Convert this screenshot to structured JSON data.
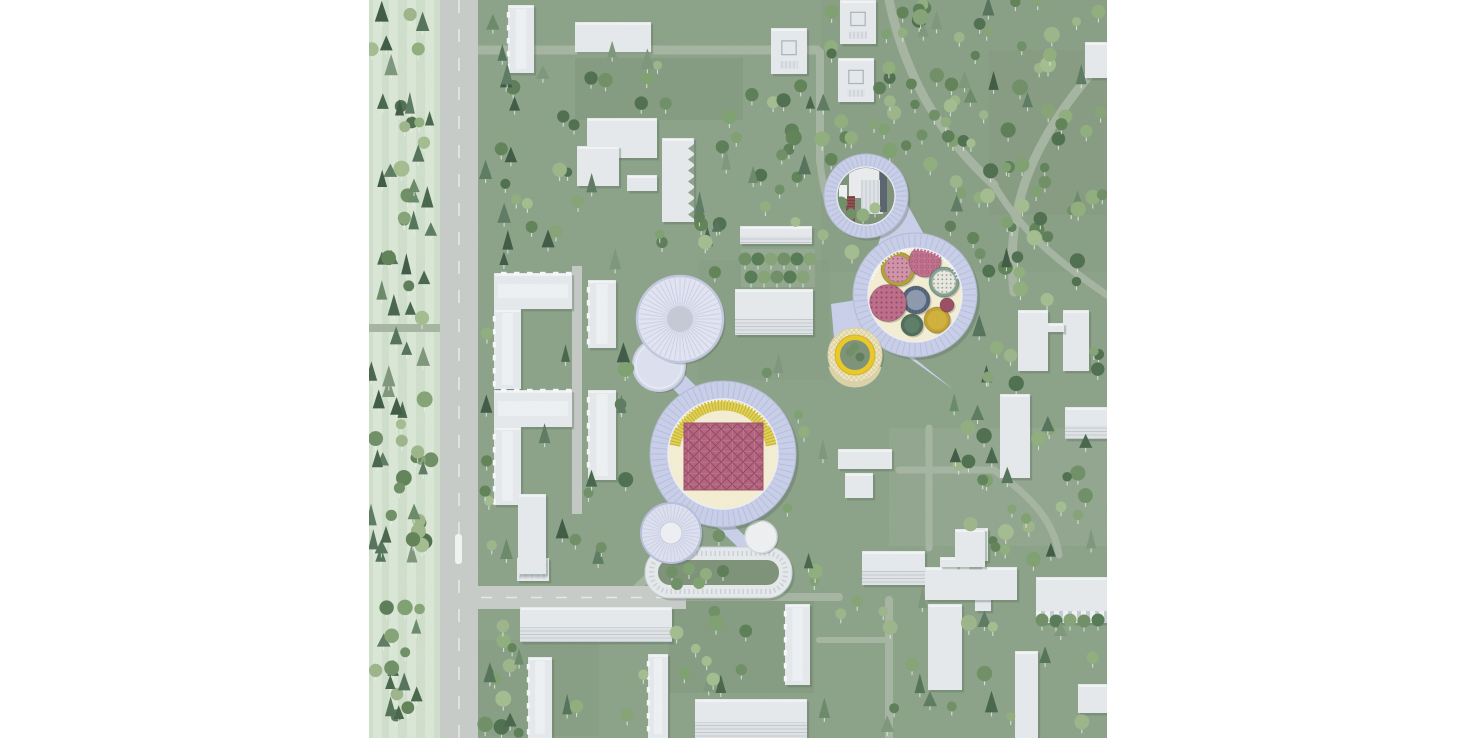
{
  "meta": {
    "title": "Aerial campus site plan illustration",
    "image_width": 1476,
    "image_height": 738,
    "map_left": 369,
    "map_size": 738,
    "visible_text": "none"
  },
  "palette": {
    "bg": "#8ba289",
    "bg_dark": "#7f957a",
    "bg_dark2": "#83987d",
    "bg_light": "#97a893",
    "pale": "#d0dfcc",
    "pale_band": "#dce9d8",
    "road": "#c7cbc8",
    "road_line": "#e8eae7",
    "path": "#a6b4a2",
    "street": "#c3c8c4",
    "bldg": "#e6e9ec",
    "bldg_hi": "#f2f4f6",
    "bldg_stripe": "#c6ccd2",
    "bldg_detail": "#aeb6bd",
    "shadow": "rgba(88,108,92,0.35)",
    "lav": "#c9cfe9",
    "lav_dark": "#b7bedb",
    "lav_light": "#e1e4f2",
    "lav_roof": "#dde1f0",
    "lav_spoke": "#ccd1e6",
    "gray_core": "#c5c9d5",
    "white_core": "#edeff4",
    "cream": "#f4eed3",
    "court_green": "#7d9278",
    "yellow": "#e4d255",
    "yellow_dark": "#c6b63b",
    "yellow_bright": "#eac827",
    "lattice": "#efe7c3",
    "rose": "#b4627d",
    "rose_line": "#8f4760",
    "olive": "#b2a232",
    "pink_top": "#cf93a8",
    "rose_disc": "#c2718c",
    "teal": "#7fa091",
    "blue": "#5a6a83",
    "blue_top": "#8c99ad",
    "rose_dot": "#bd6d88",
    "dkgreen": "#4e6e5a",
    "mustard": "#c3a02c",
    "maroon": "#9a4d64",
    "red_tower": "#7a3a3e",
    "dark_slab": "#59646f",
    "stem": "rgba(236,243,234,0.75)",
    "tree_round": [
      "#6f8f66",
      "#7fa070",
      "#8fae7d",
      "#5d7d58",
      "#a4bd8f",
      "#4f6f4f",
      "#9db58a",
      "#618257",
      "#86a377"
    ],
    "tree_conifer": [
      "#3f5a45",
      "#54735a",
      "#6a8a68",
      "#7e967b",
      "#48664c",
      "#5d7a62"
    ]
  },
  "landmarks": {
    "research_ring": {
      "cx": 546,
      "cy": 295,
      "outer_r": 62,
      "inner_r": 47,
      "cylinders": [
        {
          "name": "olive-drum",
          "cx": 529,
          "cy": 269,
          "r": 17,
          "body": "#b2a232",
          "top": "pink-dots"
        },
        {
          "name": "rose-disc",
          "cx": 556,
          "cy": 261,
          "r": 16,
          "body": "floral-rose"
        },
        {
          "name": "teal-drum",
          "cx": 575,
          "cy": 282,
          "r": 15,
          "body": "#7fa091",
          "top": "cream-dots"
        },
        {
          "name": "blue-drum",
          "cx": 547,
          "cy": 300,
          "r": 14,
          "body": "ribbed-blue",
          "top": "#8c99ad"
        },
        {
          "name": "rose-dotted-disc",
          "cx": 519,
          "cy": 303,
          "r": 18.5,
          "body": "rose-dots"
        },
        {
          "name": "green-drum",
          "cx": 543,
          "cy": 325,
          "r": 11,
          "body": "#4e6e5a"
        },
        {
          "name": "mustard-drum",
          "cx": 568,
          "cy": 320,
          "r": 13,
          "body": "#c3a02c"
        },
        {
          "name": "maroon-disc",
          "cx": 578,
          "cy": 305,
          "r": 7,
          "body": "#9a4d64"
        }
      ]
    },
    "gasholder_ring": {
      "cx": 497,
      "cy": 196,
      "outer_r": 42,
      "inner_r": 29
    },
    "yellow_pavilion": {
      "cx": 486,
      "cy": 355,
      "outer_r": 27,
      "ring_r": 20,
      "inner_r": 15
    },
    "central_ring": {
      "cx": 354,
      "cy": 454,
      "outer_r": 73,
      "inner_r": 55,
      "rose_square": [
        315,
        423,
        79,
        67
      ],
      "seating_arc": [
        190,
        350
      ]
    },
    "cylinder_pair": {
      "big": [
        311,
        319,
        43
      ],
      "small": [
        290,
        365,
        26
      ]
    },
    "round_hall": {
      "cx": 302,
      "cy": 533,
      "r": 30,
      "core_r": 11
    },
    "racetrack": {
      "x": 276,
      "y": 547,
      "w": 147,
      "h": 51,
      "rx": 25,
      "ring": 13,
      "pavilion": [
        392,
        537,
        16
      ],
      "trees": [
        [
          303,
          572
        ],
        [
          320,
          569
        ],
        [
          337,
          574
        ],
        [
          354,
          571
        ],
        [
          308,
          584
        ],
        [
          330,
          583
        ]
      ]
    },
    "plaza_polygons": [
      "527,184 568,258 504,262",
      "462,304 500,298 507,372 468,372",
      "518,342 585,390 540,354"
    ],
    "connectors": [
      [
        318,
        500,
        303,
        527,
        24
      ],
      [
        345,
        515,
        380,
        549,
        13
      ],
      [
        311,
        330,
        291,
        362,
        26
      ],
      [
        294,
        366,
        331,
        403,
        18
      ]
    ],
    "gasholder_trees": [
      [
        482,
        214
      ],
      [
        494,
        215
      ],
      [
        506,
        208
      ],
      [
        472,
        203
      ]
    ],
    "pavilion_trees": [
      [
        481,
        352
      ],
      [
        491,
        357
      ],
      [
        486,
        347
      ]
    ],
    "colonnade_trees": [
      [
        673,
        620
      ],
      [
        687,
        621
      ],
      [
        701,
        620
      ],
      [
        715,
        621
      ],
      [
        729,
        620
      ]
    ],
    "industrial": {
      "white_box": [
        480,
        158,
        30,
        40
      ],
      "striped_slab": [
        492,
        180,
        22,
        34
      ],
      "red_tower": [
        477,
        196,
        9,
        30
      ],
      "dark_slab": [
        511,
        168,
        7,
        44
      ],
      "small_blocks": [
        [
          470,
          185,
          8,
          14
        ],
        [
          486,
          152,
          12,
          8
        ]
      ]
    }
  },
  "map": {
    "pale_strip": {
      "x": 0,
      "y": 0,
      "w": 71,
      "h": 738,
      "bands": [
        4,
        20,
        38,
        56
      ]
    },
    "patches": [
      [
        206,
        58,
        168,
        62,
        "bg_dark",
        0.55
      ],
      [
        620,
        50,
        118,
        165,
        "bg_dark2",
        0.5
      ],
      [
        300,
        598,
        145,
        95,
        "bg_dark",
        0.45
      ],
      [
        100,
        640,
        130,
        96,
        "bg_dark2",
        0.4
      ],
      [
        520,
        428,
        218,
        118,
        "bg_light",
        0.55
      ],
      [
        330,
        260,
        130,
        120,
        "bg_dark2",
        0.35
      ],
      [
        452,
        0,
        286,
        272,
        "bg_dark2",
        0.3
      ]
    ],
    "roads": {
      "main": [
        71,
        0,
        38,
        738
      ],
      "branch": [
        71,
        586,
        246,
        23
      ],
      "stop_marker": [
        86,
        534,
        7,
        30
      ]
    },
    "streets": [
      [
        208,
        266,
        208,
        514
      ]
    ],
    "paths": [
      [
        "M100 50H448",
        9
      ],
      [
        "M451 52V162",
        8
      ],
      [
        "M520 0C535 70 565 130 625 185",
        9
      ],
      [
        "M738 55C665 135 635 205 645 292",
        9
      ],
      [
        "M625 185C655 235 690 262 738 295",
        7
      ],
      [
        "M316 597H470",
        8
      ],
      [
        "M520 600V738",
        8
      ],
      [
        "M530 470H625",
        7
      ],
      [
        "M560 428V548",
        7
      ],
      [
        "M625 470C660 495 685 520 690 555",
        7
      ],
      [
        "M450 640H520",
        6
      ],
      [
        "M255 600L295 562",
        8
      ],
      [
        "M0 328H70",
        8
      ],
      [
        "M451 162C455 200 463 214 470 222",
        7
      ]
    ],
    "tree_rows": {
      "band": [
        372,
        249,
        74,
        38
      ],
      "rows": [
        {
          "y": 259,
          "xs": [
            376,
            389,
            402,
            415,
            428,
            441
          ]
        },
        {
          "y": 277,
          "xs": [
            382,
            395,
            408,
            421,
            434
          ]
        }
      ]
    },
    "buildings": [
      [
        139,
        5,
        26,
        68,
        "win"
      ],
      [
        206,
        22,
        76,
        30,
        "slab"
      ],
      [
        218,
        118,
        70,
        40,
        "slab"
      ],
      [
        208,
        146,
        42,
        40,
        "slab"
      ],
      [
        258,
        175,
        30,
        16,
        "slab"
      ],
      [
        293,
        138,
        32,
        84,
        "saw"
      ],
      [
        402,
        28,
        36,
        46,
        "court"
      ],
      [
        471,
        0,
        36,
        44,
        "court"
      ],
      [
        469,
        58,
        36,
        44,
        "court"
      ],
      [
        716,
        42,
        22,
        36,
        "slab"
      ],
      [
        125,
        273,
        78,
        36,
        "win"
      ],
      [
        125,
        309,
        27,
        80,
        "win"
      ],
      [
        125,
        390,
        78,
        37,
        "win"
      ],
      [
        125,
        427,
        27,
        78,
        "win"
      ],
      [
        219,
        280,
        28,
        68,
        "win"
      ],
      [
        219,
        390,
        28,
        90,
        "win"
      ],
      [
        371,
        226,
        72,
        18,
        "striped"
      ],
      [
        366,
        289,
        78,
        46,
        "striped"
      ],
      [
        649,
        310,
        30,
        61,
        "slab"
      ],
      [
        694,
        310,
        26,
        61,
        "slab"
      ],
      [
        679,
        323,
        16,
        9,
        "slab"
      ],
      [
        631,
        394,
        30,
        84,
        "slab"
      ],
      [
        696,
        407,
        42,
        32,
        "striped"
      ],
      [
        606,
        528,
        13,
        33,
        "slab"
      ],
      [
        606,
        573,
        16,
        38,
        "slab"
      ],
      [
        667,
        577,
        71,
        46,
        "colonnade"
      ],
      [
        646,
        651,
        23,
        87,
        "slab"
      ],
      [
        709,
        684,
        29,
        29,
        "slab"
      ],
      [
        469,
        449,
        54,
        20,
        "slab"
      ],
      [
        476,
        473,
        28,
        25,
        "slab"
      ],
      [
        493,
        551,
        63,
        34,
        "striped"
      ],
      [
        556,
        567,
        92,
        33,
        "slab"
      ],
      [
        571,
        557,
        18,
        10,
        "slab"
      ],
      [
        598,
        557,
        13,
        10,
        "slab"
      ],
      [
        559,
        604,
        34,
        86,
        "slab"
      ],
      [
        586,
        529,
        30,
        38,
        "slab"
      ],
      [
        151,
        607,
        152,
        35,
        "striped"
      ],
      [
        148,
        558,
        32,
        23,
        "grid"
      ],
      [
        149,
        494,
        28,
        80,
        "slab"
      ],
      [
        159,
        657,
        24,
        81,
        "win"
      ],
      [
        279,
        654,
        20,
        84,
        "win"
      ],
      [
        416,
        604,
        25,
        81,
        "win"
      ],
      [
        326,
        699,
        112,
        39,
        "striped"
      ]
    ],
    "tree_regions": [
      [
        2,
        4,
        62,
        730,
        95,
        0.55,
        7
      ],
      [
        110,
        0,
        44,
        736,
        48,
        0.45,
        13
      ],
      [
        150,
        55,
        300,
        210,
        60,
        0.3,
        21
      ],
      [
        452,
        0,
        284,
        272,
        150,
        0.12,
        31
      ],
      [
        585,
        272,
        150,
        290,
        60,
        0.3,
        41
      ],
      [
        150,
        262,
        310,
        340,
        70,
        0.3,
        53
      ],
      [
        105,
        600,
        630,
        134,
        75,
        0.35,
        67
      ]
    ],
    "exclusions": {
      "circles": [
        [
          354,
          454,
          80
        ],
        [
          546,
          295,
          69
        ],
        [
          497,
          196,
          49
        ],
        [
          311,
          319,
          50
        ],
        [
          290,
          365,
          31
        ],
        [
          302,
          533,
          36
        ],
        [
          486,
          355,
          32
        ],
        [
          392,
          537,
          20
        ]
      ],
      "rects": [
        [
          270,
          541,
          160,
          62
        ],
        [
          65,
          0,
          48,
          738
        ],
        [
          65,
          580,
          255,
          34
        ],
        [
          370,
          246,
          78,
          44
        ],
        [
          500,
          180,
          72,
          88
        ],
        [
          458,
          294,
          52,
          84
        ],
        [
          287,
          332,
          52,
          78
        ],
        [
          202,
          262,
          13,
          256
        ]
      ]
    }
  }
}
